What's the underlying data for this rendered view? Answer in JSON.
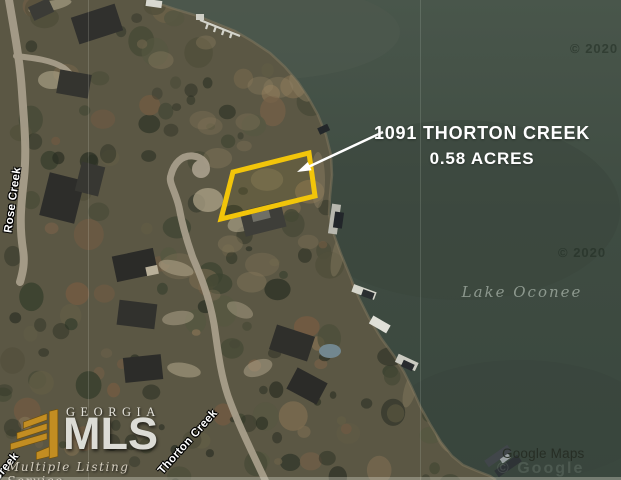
{
  "annotation": {
    "line1": "1091 THORTON CREEK",
    "line2": "0.58 ACRES"
  },
  "water_label": "Lake Oconee",
  "roads": {
    "left": "Rose Creek",
    "bottom": "Thorton Creek",
    "corner_fragment": "Creek"
  },
  "watermarks": {
    "top": "© 2020",
    "middle": "© 2020",
    "google_overlay": "© Google"
  },
  "attribution": "Google Maps",
  "logo": {
    "region": "GEORGIA",
    "name": "MLS",
    "tagline": "Multiple Listing Service"
  },
  "colors": {
    "water": "#414e44",
    "land": "#5b5744",
    "road": "#a99f8c",
    "parcel": "#f2c50a",
    "annotation_text": "#ffffff"
  }
}
